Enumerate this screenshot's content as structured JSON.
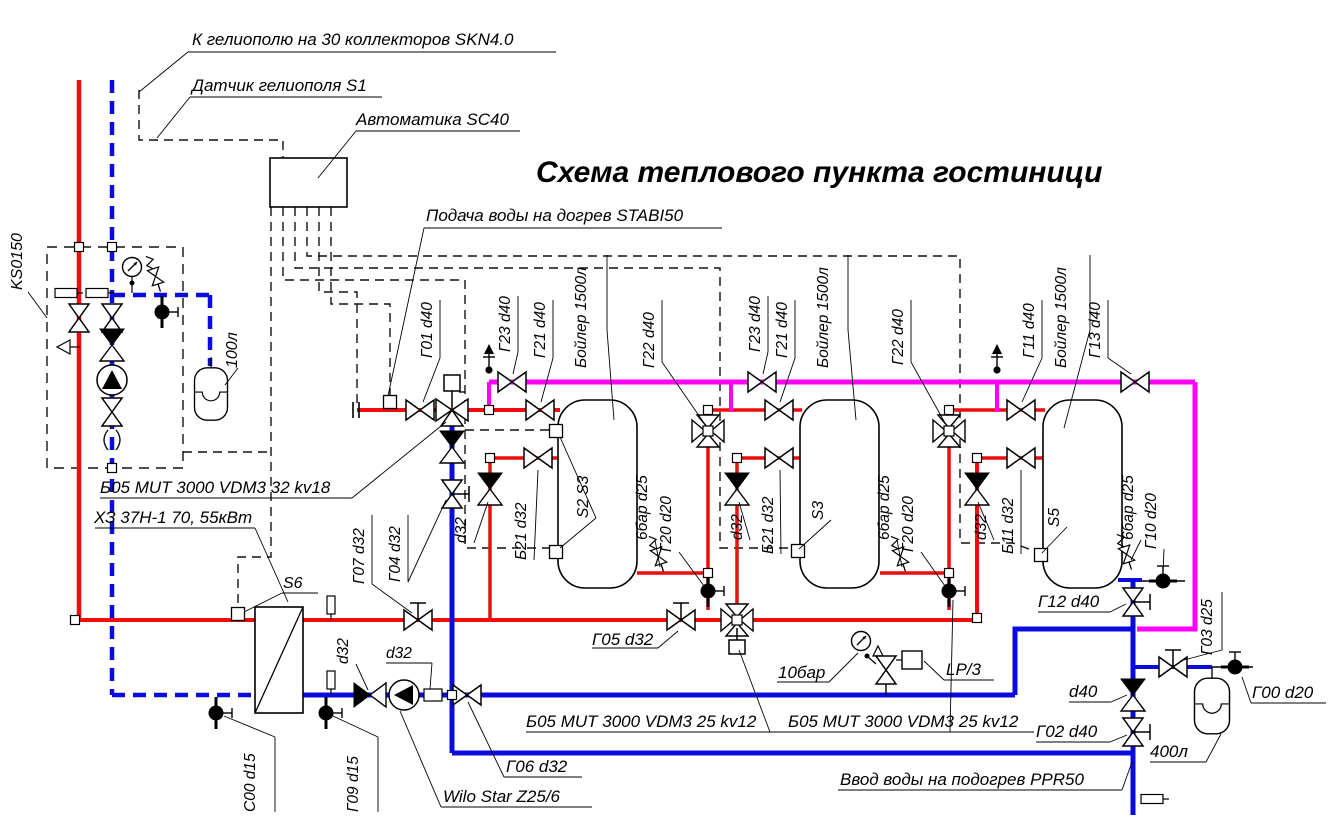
{
  "diagram_type": "heating-plant-piping-schematic",
  "colors": {
    "hot": "#ee0c0c",
    "cold": "#0b0bdd",
    "solar_circulation": "#ff00ff",
    "line": "#000000"
  },
  "title": "Схема теплового пункта гостиници",
  "labels": [
    {
      "id": "helio-field",
      "text": "К гелиополю на 30 коллекторов SKN4.0",
      "x": 192,
      "y": 45,
      "rot": 0,
      "size": 17
    },
    {
      "id": "helio-sensor",
      "text": "Датчик гелиополя S1",
      "x": 192,
      "y": 91,
      "rot": 0,
      "size": 17
    },
    {
      "id": "automation",
      "text": "Автоматика SC40",
      "x": 356,
      "y": 125,
      "rot": 0,
      "size": 17
    },
    {
      "id": "page-title",
      "text": "Схема теплового пункта гостиници",
      "x": 536,
      "y": 182,
      "rot": 0,
      "size": 30,
      "bold": true
    },
    {
      "id": "podacha",
      "text": "Подача воды на догрев STABI50",
      "x": 426,
      "y": 221,
      "rot": 0,
      "size": 17
    },
    {
      "id": "ks0150",
      "text": "KS0150",
      "x": 22,
      "y": 290,
      "rot": -90,
      "size": 16
    },
    {
      "id": "tank-100",
      "text": "100л",
      "x": 237,
      "y": 368,
      "rot": -90,
      "size": 16
    },
    {
      "id": "b05-mut-32",
      "text": "Б05 MUT 3000 VDM3 32 kv18",
      "x": 100,
      "y": 493,
      "rot": 0,
      "size": 17
    },
    {
      "id": "hx-name",
      "text": "ХЗ 37Н-1 70, 55кВт",
      "x": 94,
      "y": 523,
      "rot": 0,
      "size": 17
    },
    {
      "id": "s6",
      "text": "S6",
      "x": 283,
      "y": 588,
      "rot": 0,
      "size": 16
    },
    {
      "id": "g01",
      "text": "Г01 d40",
      "x": 432,
      "y": 358,
      "rot": -90,
      "size": 15.5
    },
    {
      "id": "g23-1",
      "text": "Г23 d40",
      "x": 510,
      "y": 352,
      "rot": -90,
      "size": 15.5
    },
    {
      "id": "g21-1",
      "text": "Г21 d40",
      "x": 545,
      "y": 358,
      "rot": -90,
      "size": 15.5
    },
    {
      "id": "boiler-1",
      "text": "Бойлер 1500л",
      "x": 586,
      "y": 368,
      "rot": -90,
      "size": 15.5
    },
    {
      "id": "g22-1",
      "text": "Г22 d40",
      "x": 654,
      "y": 368,
      "rot": -90,
      "size": 15.5
    },
    {
      "id": "g07",
      "text": "Г07 d32",
      "x": 364,
      "y": 584,
      "rot": -90,
      "size": 15.5
    },
    {
      "id": "g04",
      "text": "Г04 d32",
      "x": 400,
      "y": 582,
      "rot": -90,
      "size": 15.5
    },
    {
      "id": "d32-check",
      "text": "d32",
      "x": 348,
      "y": 664,
      "rot": -90,
      "size": 15.5
    },
    {
      "id": "d32-pump",
      "text": "d32",
      "x": 386,
      "y": 658,
      "rot": 0,
      "size": 15.5
    },
    {
      "id": "d32-sub1",
      "text": "d32",
      "x": 466,
      "y": 543,
      "rot": -90,
      "size": 15.5
    },
    {
      "id": "b21-1",
      "text": "Б21 d32",
      "x": 526,
      "y": 560,
      "rot": -90,
      "size": 15.5
    },
    {
      "id": "s2s3",
      "text": "S2 S3",
      "x": 588,
      "y": 518,
      "rot": -90,
      "size": 15.5
    },
    {
      "id": "bar6-1",
      "text": "6бар d25",
      "x": 647,
      "y": 540,
      "rot": -90,
      "size": 15.5
    },
    {
      "id": "g20-1",
      "text": "Г20 d20",
      "x": 671,
      "y": 552,
      "rot": -90,
      "size": 15.5
    },
    {
      "id": "g23-2",
      "text": "Г23 d40",
      "x": 760,
      "y": 352,
      "rot": -90,
      "size": 15.5
    },
    {
      "id": "g21-2",
      "text": "Г21 d40",
      "x": 787,
      "y": 358,
      "rot": -90,
      "size": 15.5
    },
    {
      "id": "boiler-2",
      "text": "Бойлер 1500л",
      "x": 828,
      "y": 368,
      "rot": -90,
      "size": 15.5
    },
    {
      "id": "g22-2",
      "text": "Г22 d40",
      "x": 903,
      "y": 365,
      "rot": -90,
      "size": 15.5
    },
    {
      "id": "d32-sub2",
      "text": "d32",
      "x": 742,
      "y": 540,
      "rot": -90,
      "size": 15.5
    },
    {
      "id": "b21-2",
      "text": "Б21 d32",
      "x": 773,
      "y": 554,
      "rot": -90,
      "size": 15.5
    },
    {
      "id": "s3",
      "text": "S3",
      "x": 823,
      "y": 520,
      "rot": -90,
      "size": 15.5
    },
    {
      "id": "bar6-2",
      "text": "6бар d25",
      "x": 889,
      "y": 540,
      "rot": -90,
      "size": 15.5
    },
    {
      "id": "g20-2",
      "text": "Г20 d20",
      "x": 913,
      "y": 552,
      "rot": -90,
      "size": 15.5
    },
    {
      "id": "g11",
      "text": "Г11 d40",
      "x": 1034,
      "y": 358,
      "rot": -90,
      "size": 15.5
    },
    {
      "id": "boiler-3",
      "text": "Бойлер 1500л",
      "x": 1066,
      "y": 368,
      "rot": -90,
      "size": 15.5
    },
    {
      "id": "g13",
      "text": "Г13 d40",
      "x": 1100,
      "y": 358,
      "rot": -90,
      "size": 15.5
    },
    {
      "id": "d32-sub3",
      "text": "d32",
      "x": 986,
      "y": 540,
      "rot": -90,
      "size": 15.5
    },
    {
      "id": "b11",
      "text": "Б11 d32",
      "x": 1013,
      "y": 554,
      "rot": -90,
      "size": 15.5
    },
    {
      "id": "s5",
      "text": "S5",
      "x": 1059,
      "y": 527,
      "rot": -90,
      "size": 15.5
    },
    {
      "id": "bar6-3",
      "text": "6бар d25",
      "x": 1133,
      "y": 540,
      "rot": -90,
      "size": 15.5
    },
    {
      "id": "g10",
      "text": "Г10 d20",
      "x": 1156,
      "y": 549,
      "rot": -90,
      "size": 15.5
    },
    {
      "id": "g05",
      "text": "Г05 d32",
      "x": 592,
      "y": 645,
      "rot": 0,
      "size": 17
    },
    {
      "id": "bar10",
      "text": "10бар",
      "x": 778,
      "y": 678,
      "rot": 0,
      "size": 17
    },
    {
      "id": "lp3",
      "text": "LP/3",
      "x": 946,
      "y": 675,
      "rot": 0,
      "size": 17
    },
    {
      "id": "b05-mut-25a",
      "text": "Б05 MUT 3000 VDM3 25 kv12",
      "x": 526,
      "y": 727,
      "rot": 0,
      "size": 17
    },
    {
      "id": "b05-mut-25b",
      "text": "Б05 MUT 3000 VDM3 25 kv12",
      "x": 788,
      "y": 727,
      "rot": 0,
      "size": 17
    },
    {
      "id": "g02",
      "text": "Г02 d40",
      "x": 1036,
      "y": 737,
      "rot": 0,
      "size": 17
    },
    {
      "id": "d40",
      "text": "d40",
      "x": 1069,
      "y": 697,
      "rot": 0,
      "size": 17
    },
    {
      "id": "tank-400",
      "text": "400л",
      "x": 1150,
      "y": 757,
      "rot": 0,
      "size": 17
    },
    {
      "id": "g00",
      "text": "Г00 d20",
      "x": 1252,
      "y": 698,
      "rot": 0,
      "size": 17
    },
    {
      "id": "g12",
      "text": "Г12 d40",
      "x": 1038,
      "y": 607,
      "rot": 0,
      "size": 17
    },
    {
      "id": "g03",
      "text": "Г03 d25",
      "x": 1212,
      "y": 655,
      "rot": -90,
      "size": 15.5
    },
    {
      "id": "vvod",
      "text": "Ввод воды на подогрев PPR50",
      "x": 840,
      "y": 785,
      "rot": 0,
      "size": 17
    },
    {
      "id": "wilo",
      "text": "Wilo Star Z25/6",
      "x": 443,
      "y": 802,
      "rot": 0,
      "size": 17
    },
    {
      "id": "g06",
      "text": "Г06 d32",
      "x": 506,
      "y": 772,
      "rot": 0,
      "size": 17
    },
    {
      "id": "c00",
      "text": "С00 d15",
      "x": 255,
      "y": 812,
      "rot": -90,
      "size": 15.5
    },
    {
      "id": "g09",
      "text": "Г09 d15",
      "x": 358,
      "y": 812,
      "rot": -90,
      "size": 15.5
    }
  ]
}
